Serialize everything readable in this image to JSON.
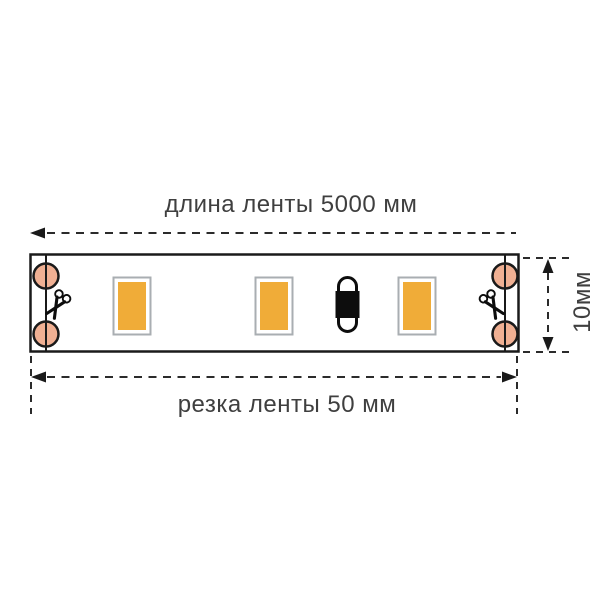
{
  "diagram": {
    "top_dimension": {
      "label": "длина ленты 5000 мм"
    },
    "bottom_dimension": {
      "label": "резка ленты 50 мм"
    },
    "side_dimension": {
      "label": "10мм"
    },
    "icons": {
      "scissors_icon": "scissors marking cut point",
      "solder_pad_icon": "round solder pad",
      "led_chip_icon": "rectangular SMD LED chip",
      "resistor_icon": "black SMD resistor capsule"
    },
    "counts": {
      "led_chips": 3,
      "solder_pads": 4,
      "scissors": 2,
      "resistors": 1
    },
    "colors": {
      "background": "#ffffff",
      "line_color": "#2b2b2b",
      "text_color": "#3f3f3f",
      "strip_border": "#1a1a1a",
      "pad_fill": "#f0b093",
      "led_fill": "#f0ac38",
      "led_border": "#a9aeb2",
      "component_black": "#0d0d0d"
    }
  }
}
